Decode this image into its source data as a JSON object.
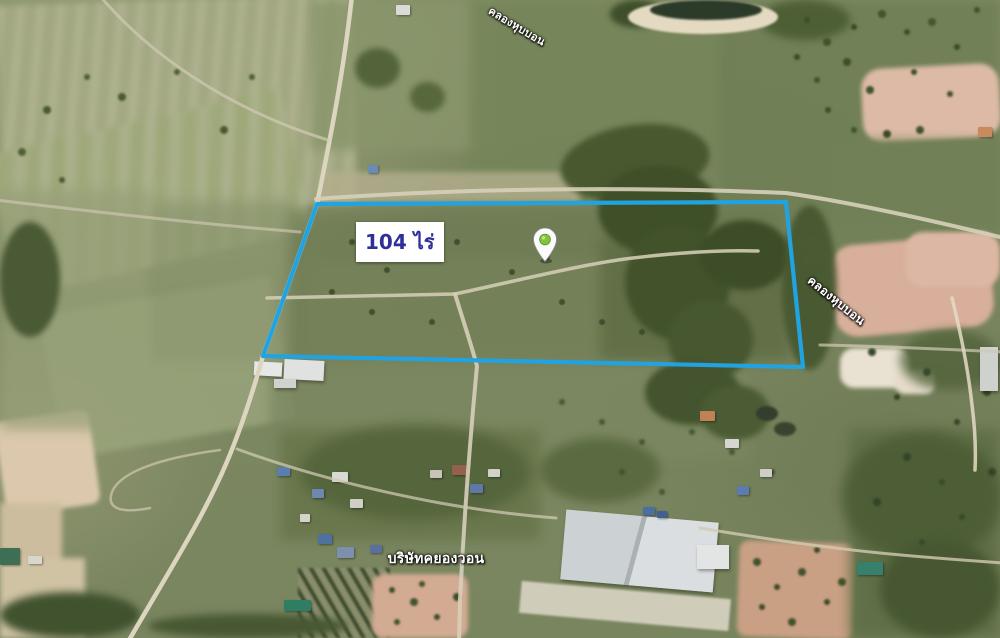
{
  "app": {
    "name": "satellite-map-view",
    "view_type": "satellite"
  },
  "map": {
    "parcel": {
      "area_label": "104 ไร่",
      "area_label_color": "#2f2f9a",
      "area_label_bg": "#ffffff",
      "outline_color": "#22a3e1"
    },
    "marker": {
      "name": "place-marker",
      "body_color": "#fbfbfb",
      "dot_color": "#7fc43c"
    },
    "place_labels": {
      "canal_top": "คลองหุบบอน",
      "canal_right": "คลองหุบบอน",
      "company": "บริษัทคยองวอน"
    }
  }
}
